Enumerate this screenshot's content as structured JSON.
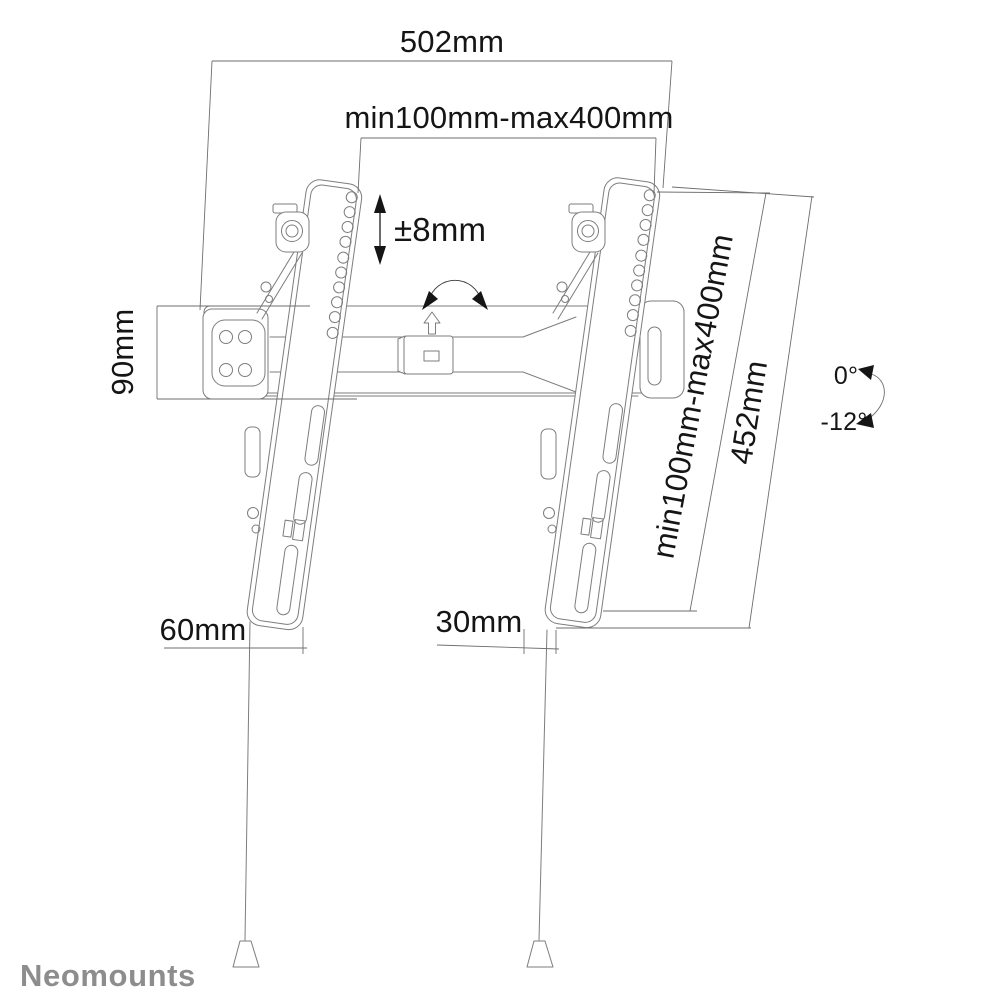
{
  "diagram": {
    "type": "technical-dimension-drawing",
    "subject": "tilting TV wall mount",
    "labels": {
      "overall_width": "502mm",
      "vesa_width_range": "min100mm-max400mm",
      "height_adjustment": "±8mm",
      "wall_plate_height": "90mm",
      "vesa_height_range": "min100mm-max400mm",
      "bracket_length": "452mm",
      "tilt_min": "0°",
      "tilt_max": "-12°",
      "bottom_offset_left": "60mm",
      "bottom_offset_right": "30mm"
    },
    "icons": {
      "height_adjust_arrow": "double-headed-vertical-arrow",
      "tilt_swing_arrow": "curved-double-arrow",
      "lift_arrow": "hollow-up-arrow",
      "tilt_angle_arrow": "curved-angle-arrow"
    }
  },
  "brand": {
    "logo": "Neomounts"
  },
  "colors": {
    "background": "#ffffff",
    "drawing_line": "#7d7d7d",
    "dimension_line": "#6e6e6e",
    "label_text": "#151515",
    "logo_text": "#8d8d8d"
  }
}
